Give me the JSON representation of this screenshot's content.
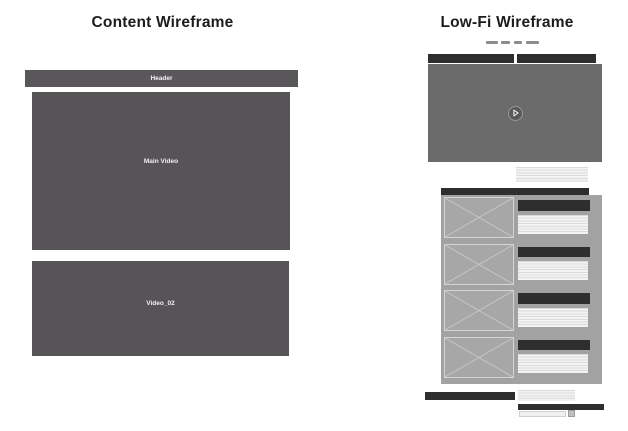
{
  "left_panel": {
    "title": "Content Wireframe",
    "header": {
      "label": "Header"
    },
    "main_video": {
      "label": "Main Video"
    },
    "video_02": {
      "label": "Video_02"
    }
  },
  "right_panel": {
    "title": "Low-Fi Wireframe",
    "nav_dashes": [
      {
        "width_px": 11.5
      },
      {
        "width_px": 9
      },
      {
        "width_px": 8.5
      },
      {
        "width_px": 13.5
      }
    ],
    "tabs": [
      {
        "name": "tab-left"
      },
      {
        "name": "tab-right"
      }
    ],
    "icons": {
      "play": "triangle-right"
    },
    "list_items": [
      {
        "type": "image-with-text-row"
      },
      {
        "type": "image-with-text-row"
      },
      {
        "type": "image-with-text-row"
      },
      {
        "type": "image-with-text-row"
      }
    ]
  },
  "colors": {
    "background": "#ffffff",
    "left_box_gray": "#575457",
    "header_gray": "#5a575a",
    "video_gray": "#6b6b6b",
    "dark_bar": "#2e2e2e",
    "list_container_gray": "#a2a2a2",
    "image_placeholder_gray": "#a7a7a7",
    "stripe_line": "#dbdbdb",
    "nav_dash_gray": "#8d8d8d",
    "title_text": "#1c1c1c"
  }
}
